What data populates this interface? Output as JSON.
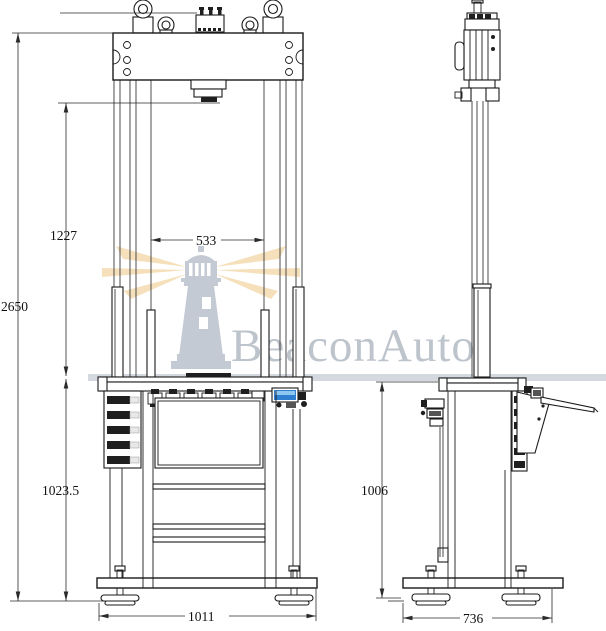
{
  "watermark": {
    "brand": "BeaconAuto"
  },
  "dimensions": {
    "overall_height": "2650",
    "daylight_opening": "1227",
    "between_columns": "533",
    "table_to_ground": "1023.5",
    "front_base_width": "1011",
    "side_table_height": "1006",
    "side_base_depth": "736"
  },
  "colors": {
    "line": "#1a1a1a",
    "watermark_gray": "#c3cad3",
    "beam_light": "#f4ddb4",
    "display_blue": "#2f7fd0"
  }
}
